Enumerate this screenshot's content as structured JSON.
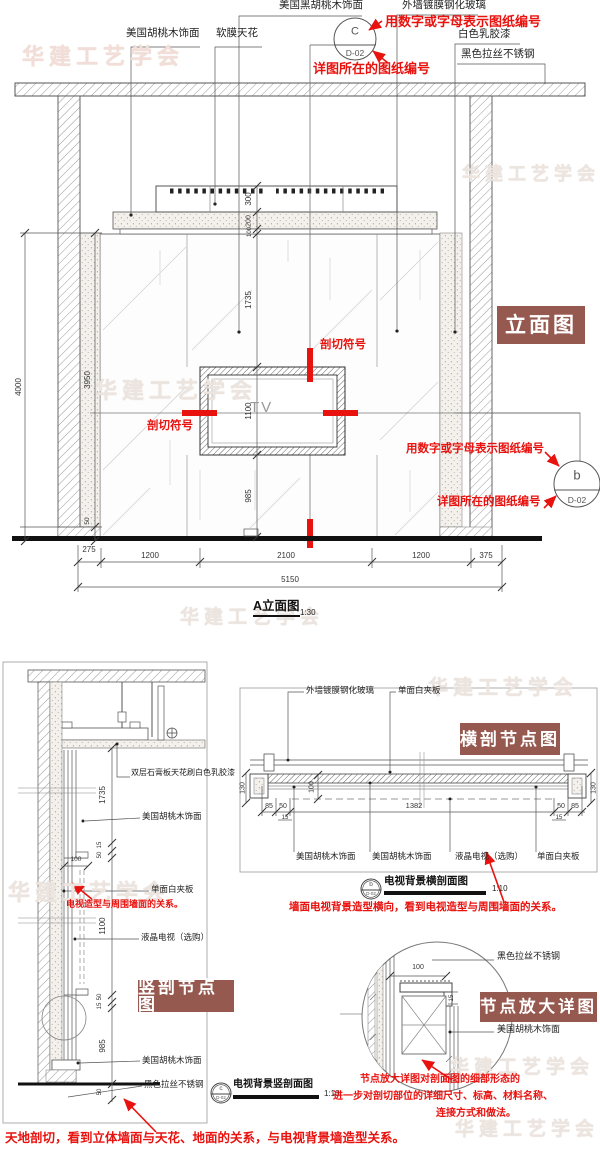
{
  "watermark_text": "华建工艺学会",
  "colors": {
    "badge_bg": "#96594f",
    "annotation_red": "#e8120e"
  },
  "elevation": {
    "badge": "立面图",
    "labels": {
      "walnut": "美国胡桃木饰面",
      "soft_ceiling": "软膜天花",
      "black_walnut": "美国黑胡桃木饰面",
      "glass": "外墙镀膜钢化玻璃",
      "white_paint": "白色乳胶漆",
      "black_steel": "黑色拉丝不锈钢"
    },
    "callout_top": {
      "letter": "C",
      "sheet": "D-02"
    },
    "callout_right": {
      "letter": "b",
      "sheet": "D-02"
    },
    "red_notes": {
      "number_top": "用数字或字母表示图纸编号",
      "sheet_top": "详图所在的图纸编号",
      "number_right": "用数字或字母表示图纸编号",
      "sheet_right": "详图所在的图纸编号",
      "cut_top": "剖切符号",
      "cut_left": "剖切符号"
    },
    "tv_label": "TV",
    "dims": {
      "total_height": "4000",
      "wall_height": "3950",
      "floor": "50",
      "v300": "300",
      "v200": "200",
      "v100": "100",
      "v1735": "1735",
      "v1100": "1100",
      "v985": "985",
      "b275": "275",
      "b1200_left": "1200",
      "b2100": "2100",
      "b1200_right": "1200",
      "b375": "375",
      "total_width": "5150"
    },
    "title": {
      "name": "A立面图",
      "scale": "1:30"
    }
  },
  "vertical_section": {
    "badge": "竖剖节点图",
    "labels": {
      "gypsum": "双层石膏板天花刷白色乳胶漆",
      "walnut_top": "美国胡桃木饰面",
      "white_board": "单面白夹板",
      "lcd": "液晶电视（选购）",
      "walnut_bottom": "美国胡桃木饰面",
      "black_steel": "黑色拉丝不锈钢"
    },
    "red_note": "电视造型与周围墙面的关系。",
    "dims": {
      "d1735": "1735",
      "d15a": "15",
      "d50a": "50",
      "d100": "100",
      "d1100": "1100",
      "d50b": "50",
      "d15b": "15",
      "d985": "985",
      "d50c": "50"
    },
    "title": {
      "letter": "c",
      "sheet": "D-02",
      "name": "电视背景竖剖面图",
      "scale": "1:10"
    }
  },
  "horizontal_section": {
    "badge": "横剖节点图",
    "labels": {
      "glass": "外墙镀膜钢化玻璃",
      "white_board_top": "单面白夹板",
      "walnut_a": "美国胡桃木饰面",
      "walnut_b": "美国胡桃木饰面",
      "lcd": "液晶电视（选购）",
      "white_board": "单面白夹板"
    },
    "dims": {
      "left130": "130",
      "right130": "130",
      "d100": "100",
      "l85": "85",
      "l50": "50",
      "l15": "15",
      "c1382": "1382",
      "r50": "50",
      "r85": "85",
      "r15": "15"
    },
    "title": {
      "letter": "b",
      "sheet": "D-02",
      "name": "电视背景横剖面图",
      "scale": "1:10"
    },
    "red_note": "墙面电视背景造型横向，看到电视造型与周围墙面的关系。"
  },
  "node_detail": {
    "badge": "节点放大详图",
    "labels": {
      "black_steel": "黑色拉丝不锈钢",
      "walnut": "美国胡桃木饰面"
    },
    "dims": {
      "d100": "100",
      "d15": "15"
    },
    "red_note_lines": [
      "节点放大详图对剖面图的细部形态的",
      "进一步对剖切部位的详细尺寸、标高、材料名称、",
      "连接方式和做法。"
    ]
  },
  "bottom_note": "天地剖切，看到立体墙面与天花、地面的关系，与电视背景墙造型关系。"
}
